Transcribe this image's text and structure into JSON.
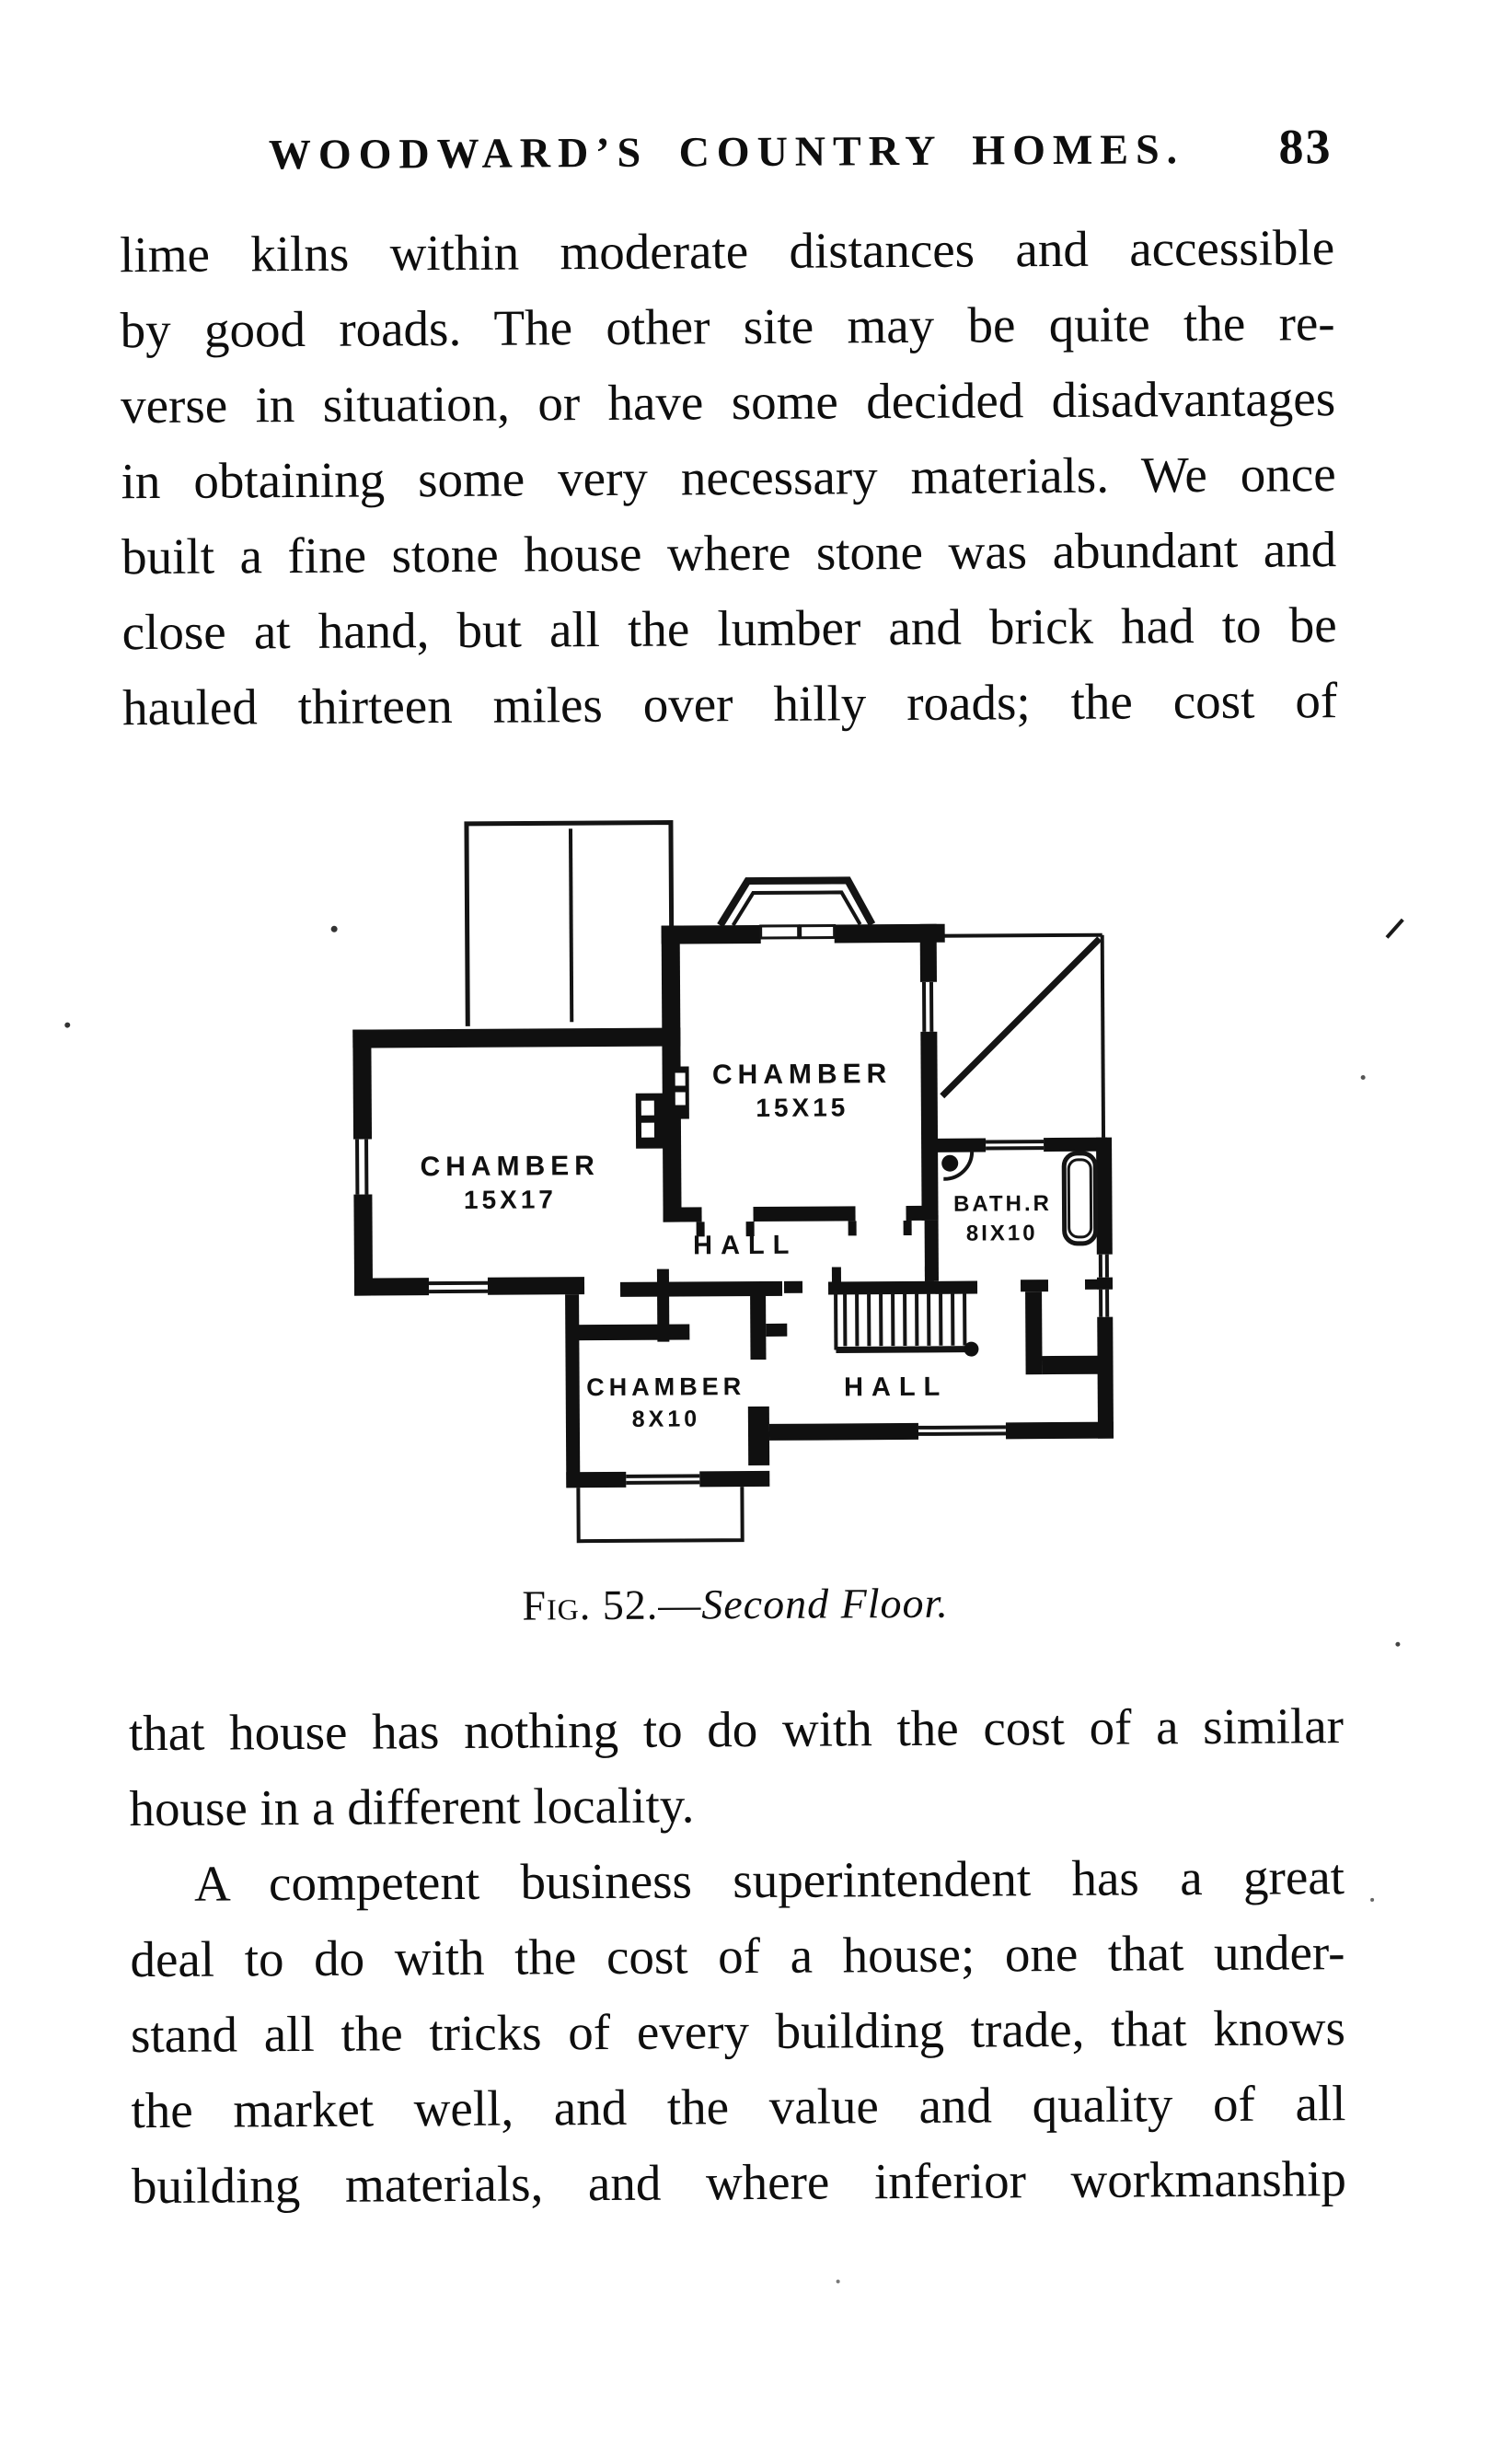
{
  "page": {
    "header": {
      "title": "WOODWARD’S COUNTRY HOMES.",
      "page_number": "83"
    },
    "paragraph1_lines": [
      {
        "text": "lime kilns within moderate distances and accessible",
        "justify": true,
        "indent": false
      },
      {
        "text": "by good roads.  The other site may be quite the re-",
        "justify": true,
        "indent": false
      },
      {
        "text": "verse in situation, or have some decided disadvantages",
        "justify": true,
        "indent": false
      },
      {
        "text": "in obtaining some very necessary materials.  We once",
        "justify": true,
        "indent": false
      },
      {
        "text": "built a fine stone house where stone was abundant and",
        "justify": true,
        "indent": false
      },
      {
        "text": "close at hand, but all the lumber and brick had to be",
        "justify": true,
        "indent": false
      },
      {
        "text": "hauled thirteen miles over hilly roads; the cost of",
        "justify": true,
        "indent": false
      }
    ],
    "figure": {
      "caption_label": "Fig. 52.",
      "caption_dash": "—",
      "caption_title": "Second Floor.",
      "labels": {
        "chamber_15x17": {
          "line1": "CHAMBER",
          "line2": "15X17"
        },
        "chamber_15x15": {
          "line1": "CHAMBER",
          "line2": "15X15"
        },
        "chamber_8x10": {
          "line1": "CHAMBER",
          "line2": "8X10"
        },
        "bathroom": {
          "line1": "BATH.R",
          "line2": "8IX10"
        },
        "hall_upper": "HALL",
        "hall_lower": "HALL"
      }
    },
    "paragraph2_lines": [
      {
        "text": "that house has nothing to do with the cost of a similar",
        "justify": true,
        "indent": false
      },
      {
        "text": "house in a different locality.",
        "justify": false,
        "indent": false
      },
      {
        "text": "A competent business superintendent has a great",
        "justify": true,
        "indent": true
      },
      {
        "text": "deal to do with the cost of a house; one that under-",
        "justify": true,
        "indent": false
      },
      {
        "text": "stand all the tricks of every building trade, that knows",
        "justify": true,
        "indent": false
      },
      {
        "text": "the market well, and the value and quality of all",
        "justify": true,
        "indent": false
      },
      {
        "text": "building materials, and where inferior workmanship",
        "justify": true,
        "indent": false
      }
    ]
  }
}
